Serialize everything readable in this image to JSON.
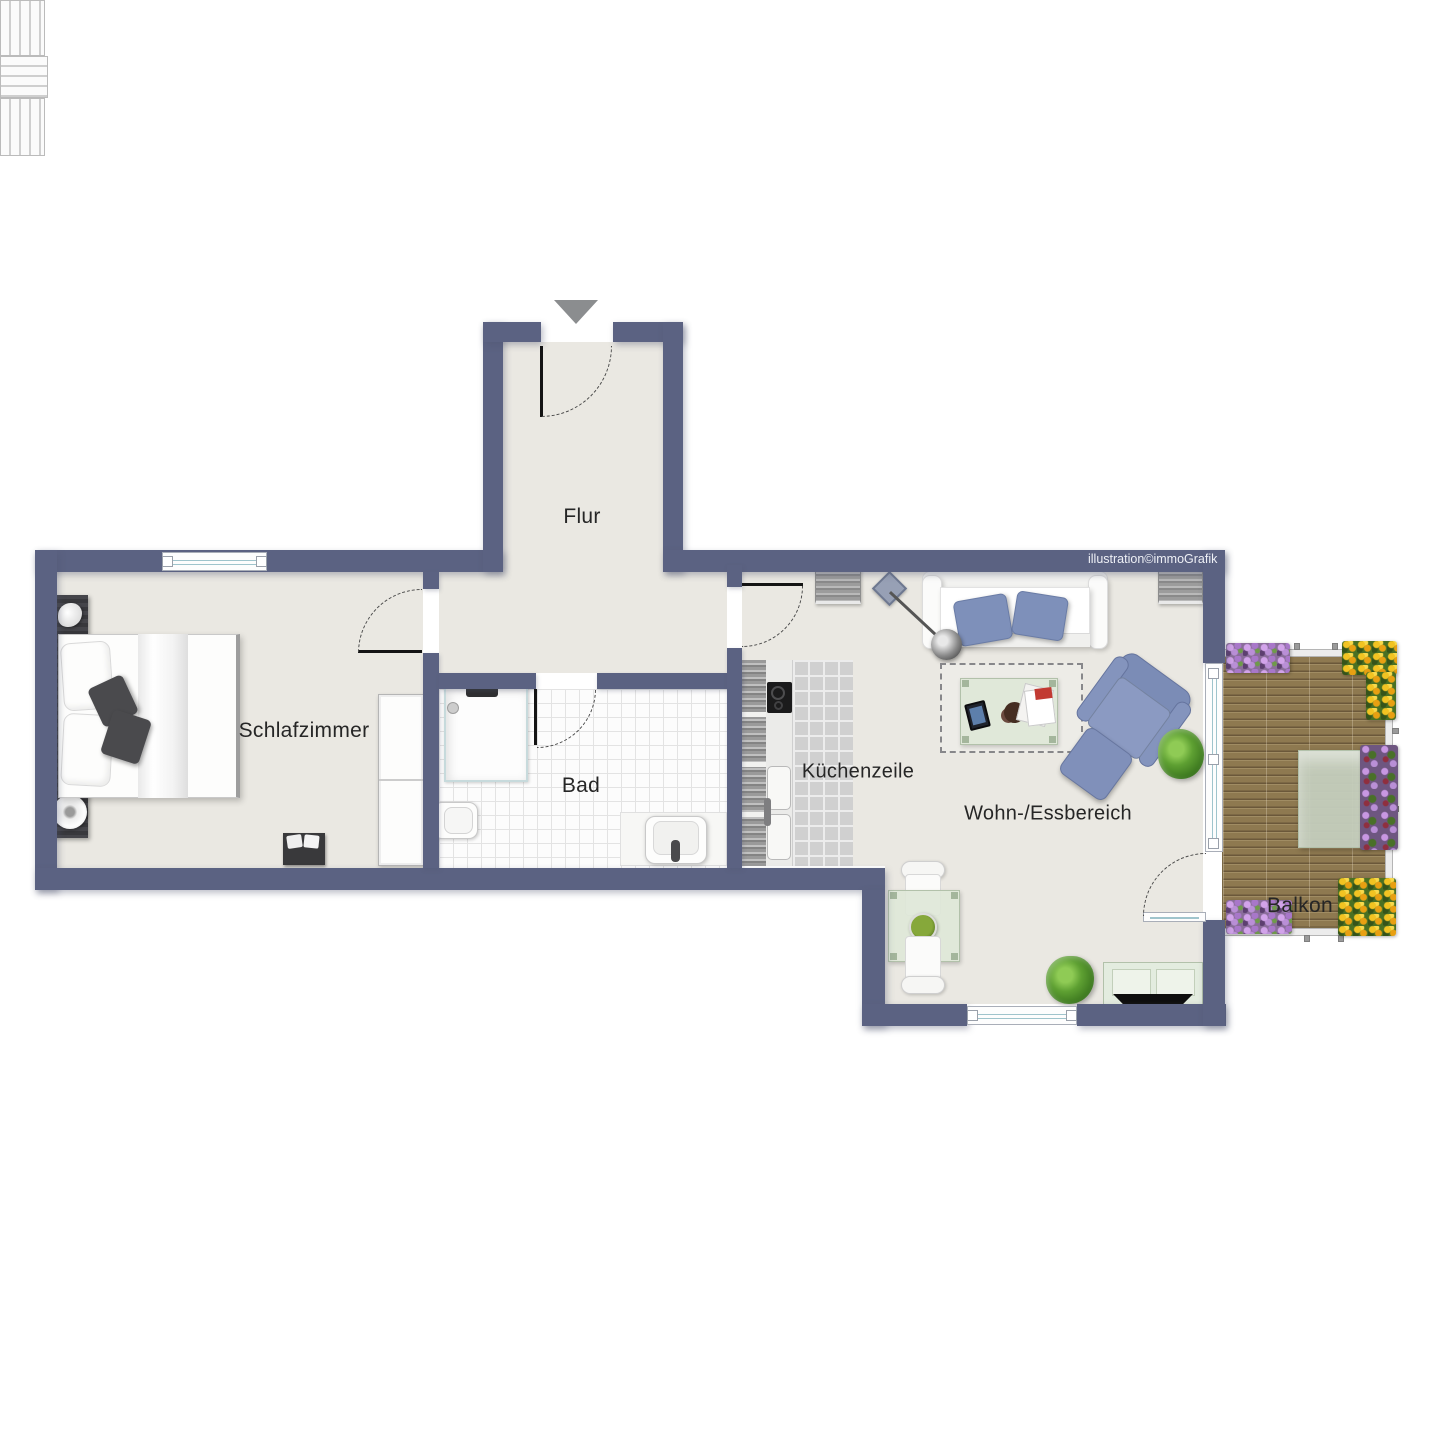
{
  "plan": {
    "type": "apartment-floor-plan",
    "watermark": "illustration©immoGrafik",
    "rooms": {
      "flur": {
        "label": "Flur"
      },
      "schlafzimmer": {
        "label": "Schlafzimmer"
      },
      "bad": {
        "label": "Bad"
      },
      "kueche": {
        "label": "Küchenzeile"
      },
      "wohnen": {
        "label": "Wohn-/Essbereich"
      },
      "balkon": {
        "label": "Balkon"
      }
    },
    "colors": {
      "wall": "#5b6282",
      "floor": "#eae8e2",
      "bath_tile": "#fcfcfc",
      "kitchen_tile": "#d0d0d0",
      "accent_blue_furniture": "#8090ba",
      "glass_green": "#dfe7d9",
      "deck_wood": "#8e7950",
      "window_glass": "#9fc4cc",
      "entrance_arrow": "#8b8d8f"
    },
    "doors": [
      {
        "name": "entrance-door",
        "between": "outside → Flur"
      },
      {
        "name": "bedroom-door",
        "between": "Flur → Schlafzimmer"
      },
      {
        "name": "bathroom-door",
        "between": "Flur → Bad"
      },
      {
        "name": "living-door",
        "between": "Flur → Wohn-/Essbereich"
      },
      {
        "name": "balcony-door",
        "between": "Wohn-/Essbereich → Balkon"
      }
    ],
    "windows": [
      {
        "name": "bedroom-window",
        "wall": "top"
      },
      {
        "name": "dining-window",
        "wall": "bottom"
      },
      {
        "name": "balcony-window-front",
        "wall": "right"
      }
    ],
    "furniture": {
      "schlafzimmer": [
        "double-bed",
        "headboard-nightstands",
        "bedside-lamp",
        "bench",
        "wardrobe"
      ],
      "bad": [
        "shower",
        "toilet",
        "washbasin"
      ],
      "kueche": [
        "kitchen-counter",
        "cooktop",
        "kitchen-sink"
      ],
      "wohnen": [
        "sofa",
        "blue-cushions",
        "floor-lamp",
        "rug",
        "coffee-table",
        "tablet",
        "magazines",
        "armchair",
        "ottoman",
        "potted-plant",
        "dining-table",
        "two-chairs",
        "salad-bowl",
        "tv-lowboard",
        "tv",
        "second-plant",
        "sideboard-left",
        "sideboard-right"
      ],
      "balkon": [
        "wood-deck",
        "garden-table",
        "three-garden-chairs",
        "flower-boxes"
      ]
    }
  }
}
